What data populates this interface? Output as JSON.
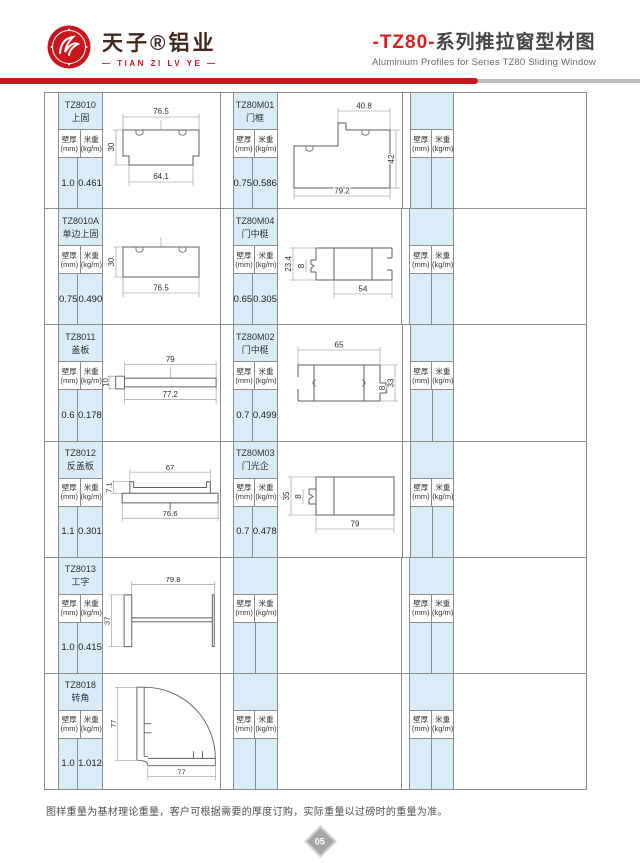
{
  "header": {
    "brand_cn": "天子®铝业",
    "brand_en": "— TIAN ZI LV YE —",
    "title_series": "-TZ80-",
    "title_cn": "系列推拉窗型材图",
    "subtitle_en": "Aluminium Profiles for Series TZ80 Sliding Window"
  },
  "col": {
    "t1": "壁厚",
    "t2": "(mm)",
    "w1": "米重",
    "w2": "(kg/m)"
  },
  "rows": [
    {
      "g1": {
        "code": "TZ8010",
        "name": "上固",
        "t": "1.0",
        "w": "0.461"
      },
      "g2": {
        "code": "TZ80M01",
        "name": "门框",
        "t": "0.75",
        "w": "0.586"
      }
    },
    {
      "g1": {
        "code": "TZ8010A",
        "name": "单边上固",
        "t": "0.75",
        "w": "0.490"
      },
      "g2": {
        "code": "TZ80M04",
        "name": "门中梃",
        "t": "0.65",
        "w": "0.305"
      }
    },
    {
      "g1": {
        "code": "TZ8011",
        "name": "盖板",
        "t": "0.6",
        "w": "0.178"
      },
      "g2": {
        "code": "TZ80M02",
        "name": "门中梃",
        "t": "0.7",
        "w": "0.499"
      }
    },
    {
      "g1": {
        "code": "TZ8012",
        "name": "反盖板",
        "t": "1.1",
        "w": "0.301"
      },
      "g2": {
        "code": "TZ80M03",
        "name": "门光企",
        "t": "0.7",
        "w": "0.478"
      }
    },
    {
      "g1": {
        "code": "TZ8013",
        "name": "工字",
        "t": "1.0",
        "w": "0.415"
      },
      "g2": {
        "code": "",
        "name": "",
        "t": "",
        "w": ""
      }
    },
    {
      "g1": {
        "code": "TZ8018",
        "name": "转角",
        "t": "1.0",
        "w": "1.012"
      },
      "g2": {
        "code": "",
        "name": "",
        "t": "",
        "w": ""
      }
    }
  ],
  "dims": {
    "tz8010": {
      "top": "76.5",
      "left": "30",
      "bottom": "64.1"
    },
    "tz80m01": {
      "top": "40.8",
      "right": "42",
      "bottom": "79.2"
    },
    "tz8010a": {
      "left": "30",
      "bottom": "76.5"
    },
    "tz80m04": {
      "left": "23.4",
      "inner": "8",
      "bottom": "54"
    },
    "tz8011": {
      "top": "79",
      "left": "10",
      "bottom": "77.2"
    },
    "tz80m02": {
      "top": "65",
      "inner": "8",
      "right": "33"
    },
    "tz8012": {
      "top": "67",
      "left": "7.1",
      "bottom": "76.6"
    },
    "tz80m03": {
      "left": "35",
      "inner": "8",
      "bottom": "79"
    },
    "tz8013": {
      "top": "79.8",
      "left": "37"
    },
    "tz8018": {
      "left": "77",
      "bottom": "77"
    }
  },
  "footer": {
    "note": "图样重量为基材理论重量，客户可根据需要的厚度订购，实际重量以过磅时的重量为准。",
    "page": "05"
  }
}
